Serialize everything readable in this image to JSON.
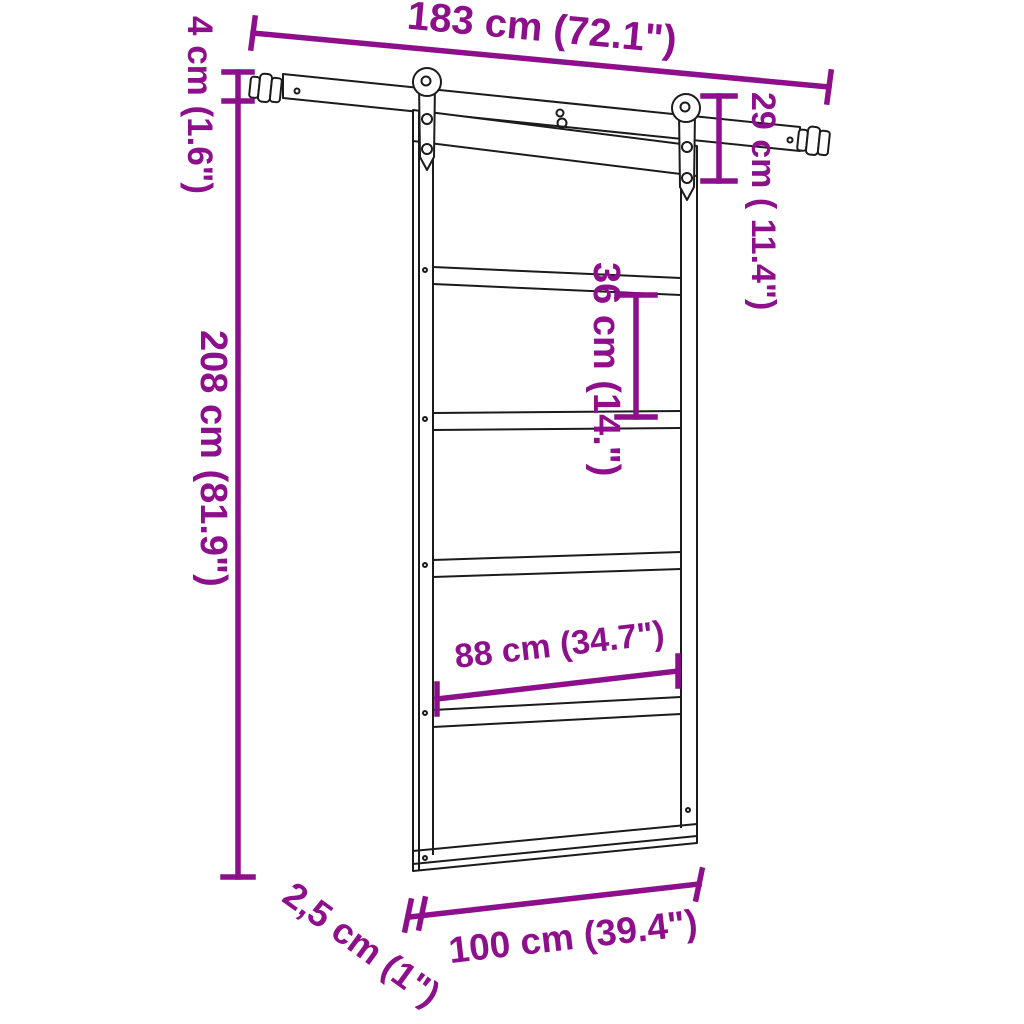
{
  "diagram": {
    "colors": {
      "annotation": "#8E0F8C",
      "line_art": "#1b1b1b",
      "background": "#ffffff"
    },
    "labels": {
      "track_length": "183 cm (72.1\")",
      "stopper_height": "4 cm (1.6\")",
      "door_height": "208 cm (81.9\")",
      "hanger_drop": "29 cm ( 11.4\")",
      "panel_height": "36 cm (14.\")",
      "panel_width": "88 cm (34.7\")",
      "door_width": "100 cm (39.4\")",
      "door_thickness": "2,5 cm (1\")"
    }
  }
}
